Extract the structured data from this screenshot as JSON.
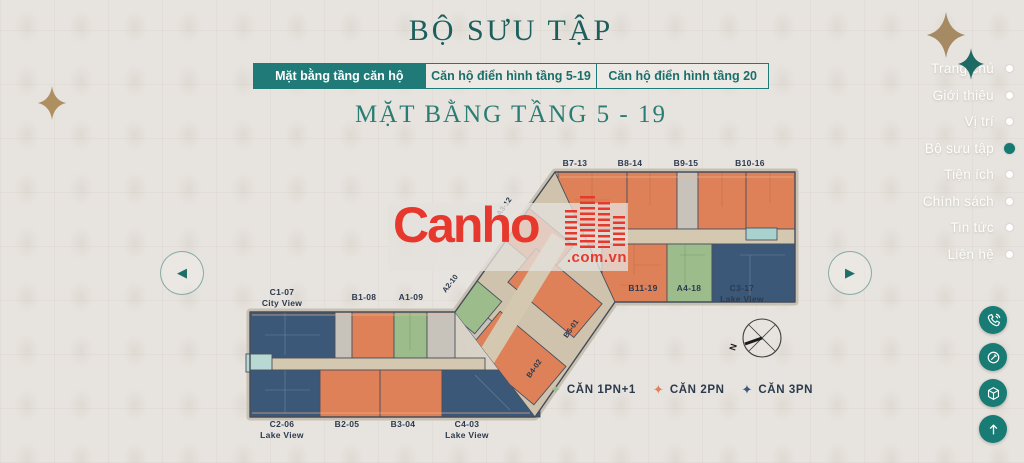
{
  "page": {
    "title": "BỘ SƯU TẬP",
    "subtitle": "MẶT BẰNG TẦNG 5 - 19"
  },
  "tabs": [
    {
      "label": "Mặt bằng tầng căn hộ",
      "active": true
    },
    {
      "label": "Căn hộ điển hình tầng 5-19",
      "active": false
    },
    {
      "label": "Căn hộ điển hình tầng 20",
      "active": false
    }
  ],
  "nav": {
    "items": [
      {
        "label": "Trang chủ",
        "active": false
      },
      {
        "label": "Giới thiệu",
        "active": false
      },
      {
        "label": "Vị trí",
        "active": false
      },
      {
        "label": "Bộ sưu tập",
        "active": true
      },
      {
        "label": "Tiện ích",
        "active": false
      },
      {
        "label": "Chính sách",
        "active": false
      },
      {
        "label": "Tin tức",
        "active": false
      },
      {
        "label": "Liên hệ",
        "active": false
      }
    ]
  },
  "floorplan": {
    "upper_top": [
      "B7-13",
      "B8-14",
      "B9-15",
      "B10-16"
    ],
    "upper_bottom": [
      {
        "id": "B11-19"
      },
      {
        "id": "A4-18"
      },
      {
        "id": "C3-17",
        "view": "Lake View"
      }
    ],
    "lower_top": [
      {
        "id": "C1-07",
        "view": "City View"
      },
      {
        "id": "B1-08"
      },
      {
        "id": "A1-09"
      }
    ],
    "lower_bottom": [
      {
        "id": "C2-06",
        "view": "Lake View"
      },
      {
        "id": "B2-05"
      },
      {
        "id": "B3-04"
      },
      {
        "id": "C4-03",
        "view": "Lake View"
      }
    ],
    "diagonal": {
      "a3": "A3-12",
      "a2": "A2-10",
      "b5": "B5-01",
      "b4": "B4-02"
    },
    "compass_n": "N"
  },
  "legend": {
    "items": [
      {
        "label": "CĂN 1PN+1",
        "color": "#9cbd8b"
      },
      {
        "label": "CĂN 2PN",
        "color": "#e08258"
      },
      {
        "label": "CĂN 3PN",
        "color": "#3d5a78"
      }
    ]
  },
  "watermark": {
    "brand": "Canho",
    "domain": ".com.vn"
  },
  "colors": {
    "accent_teal": "#1f7a78",
    "title_teal": "#1c5f5c",
    "unit_orange": "#df8158",
    "unit_green": "#9cbd8b",
    "unit_blue": "#3b5878",
    "corridor_beige": "#d5c8b0",
    "watermark_red": "#e7382d",
    "star_gold": "#a58a63",
    "background": "#e7e3de"
  }
}
